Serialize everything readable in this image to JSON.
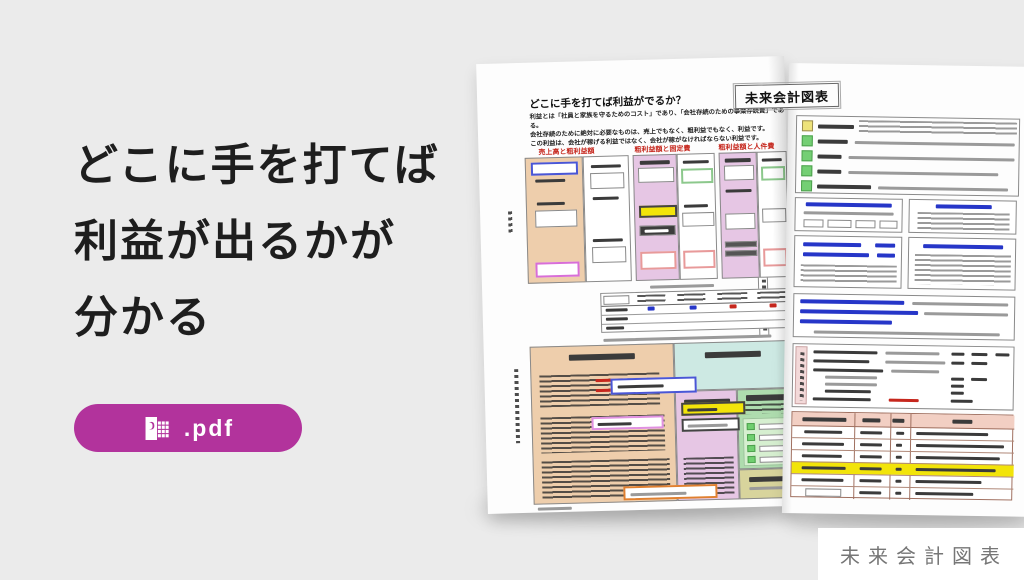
{
  "colors": {
    "background": "#ebebeb",
    "accent_magenta": "#b2339c",
    "highlight_yellow": "#f2e40a",
    "label_red": "#c6271d",
    "link_blue": "#2636c8"
  },
  "hero": {
    "heading_lines": [
      "どこに手を打てば",
      "利益が出るかが",
      "分かる"
    ],
    "pdf_button": {
      "label": ".pdf",
      "icon": "spreadsheet-file-icon"
    }
  },
  "brochure": {
    "title": "未来会計図表",
    "left_page": {
      "heading": "どこに手を打てば利益がでるか？",
      "intro_lines": [
        "利益とは「社員と家族を守るためのコスト」であり、「会社存続のための事業存続費」である。",
        "会社存続のために絶対に必要なものは、売上でもなく、粗利益でもなく、利益です。",
        "この利益は、会社が稼げる利益ではなく、会社が稼がなければならない利益です。"
      ],
      "column_captions": [
        "売上高と粗利益額",
        "粗利益額と固定費",
        "粗利益額と人件費"
      ]
    }
  },
  "corner_label": "未来会計図表"
}
